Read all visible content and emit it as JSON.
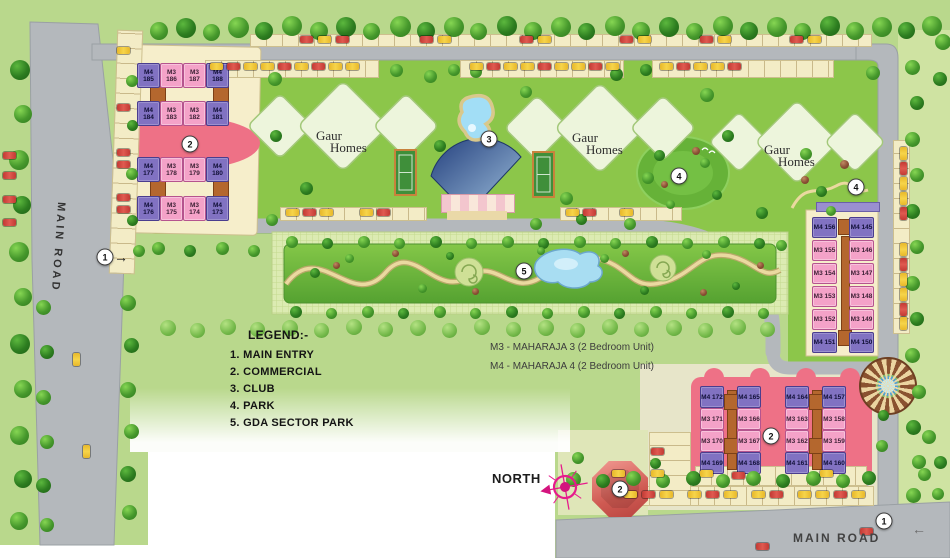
{
  "legend": {
    "title": "LEGEND:-",
    "items": [
      "1. MAIN ENTRY",
      "2. COMMERCIAL",
      "3. CLUB",
      "4. PARK",
      "5. GDA SECTOR PARK"
    ]
  },
  "unit_key": {
    "m3": "M3 - MAHARAJA 3 (2 Bedroom Unit)",
    "m4": "M4 - MAHARAJA 4 (2 Bedroom Unit)"
  },
  "labels": {
    "north": "NORTH",
    "main_road_left": "MAIN ROAD",
    "main_road_bottom": "MAIN ROAD"
  },
  "gaur_homes": {
    "line1": "Gaur",
    "line2": "Homes"
  },
  "markers": {
    "main_entry": "1",
    "commercial": "2",
    "club": "3",
    "park": "4",
    "gda_sector_park": "5"
  },
  "colors": {
    "m3_unit": "#f4a2c8",
    "m4_unit": "#8172c2",
    "commercial": "#ee7186",
    "road": "#b4b8bc",
    "lawn": "#b9d88c"
  },
  "clusters": {
    "northwest": {
      "rows": [
        [
          "M4 185",
          "M3 186",
          "M3 187",
          "M4 188"
        ],
        [
          "M4 184",
          "M3 183",
          "M3 182",
          "M4 181"
        ],
        [
          "M4 177",
          "M3 178",
          "M3 179",
          "M4 180"
        ],
        [
          "M4 176",
          "M3 175",
          "M3 174",
          "M4 173"
        ]
      ]
    },
    "east": {
      "columns": [
        [
          "M4 156",
          "M3 155",
          "M3 154",
          "M3 153",
          "M3 152",
          "M4 151"
        ],
        [
          "M4 145",
          "M3 146",
          "M3 147",
          "M3 148",
          "M3 149",
          "M4 150"
        ]
      ]
    },
    "southeast": {
      "columns": [
        [
          "M4 172",
          "M3 171",
          "M3 170",
          "M4 169"
        ],
        [
          "M4 165",
          "M3 166",
          "M3 167",
          "M4 168"
        ],
        [
          "M4 164",
          "M3 163",
          "M3 162",
          "M4 161"
        ],
        [
          "M4 157",
          "M3 158",
          "M3 159",
          "M4 160"
        ]
      ]
    }
  }
}
